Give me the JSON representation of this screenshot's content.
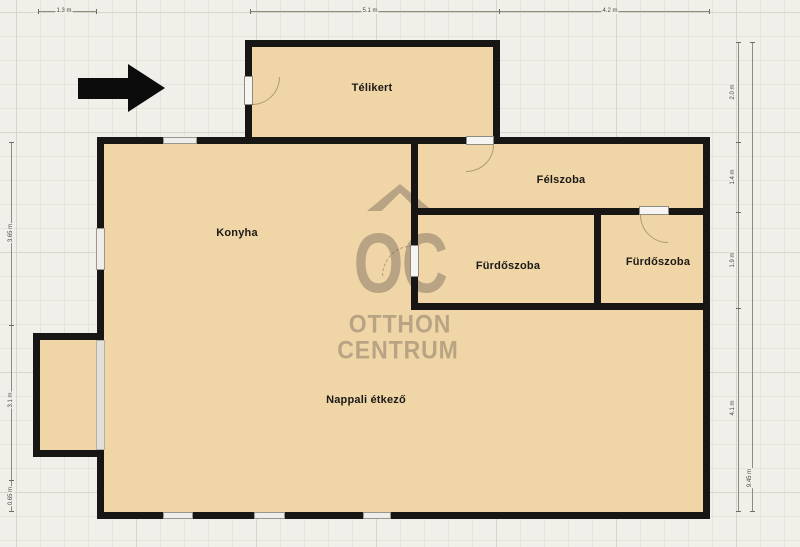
{
  "rooms": [
    {
      "label": "Télikert"
    },
    {
      "label": "Félszoba"
    },
    {
      "label": "Konyha"
    },
    {
      "label": "Fürdőszoba"
    },
    {
      "label": "Fürdőszoba"
    },
    {
      "label": "Nappali étkező"
    }
  ],
  "watermark": {
    "monogram": "OC",
    "line1": "OTTHON",
    "line2": "CENTRUM"
  },
  "dimensions": {
    "top": [
      {
        "label": "1.3 m"
      },
      {
        "label": "5.1 m"
      },
      {
        "label": "4.2 m"
      }
    ],
    "left": [
      {
        "label": "3.65 m"
      },
      {
        "label": "3.1 m"
      },
      {
        "label": "0.65 m"
      }
    ],
    "right": [
      {
        "label": "2.0 m"
      },
      {
        "label": "1.4 m"
      },
      {
        "label": "1.9 m"
      },
      {
        "label": "4.1 m"
      },
      {
        "label": "9.45 m"
      }
    ]
  },
  "colors": {
    "bg": "#f0efea",
    "grid_minor": "#e5e3dc",
    "grid_major": "#d8d5cb",
    "room_fill": "#f0d5a6",
    "wall": "#171614",
    "logo": "rgba(115,104,92,0.45)",
    "label_text": "#1b1a18"
  }
}
